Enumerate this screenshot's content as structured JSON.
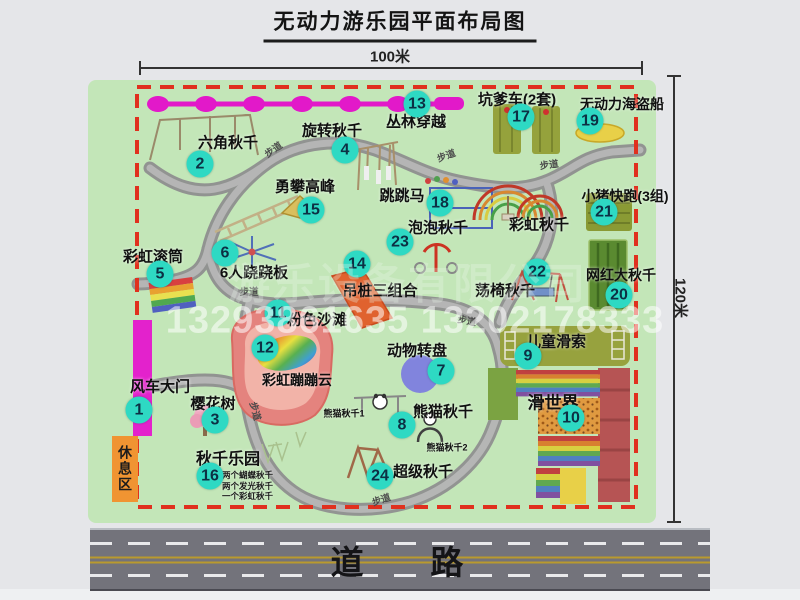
{
  "title": "无动力游乐园平面布局图",
  "dimensions": {
    "top": "100米",
    "right": "120米"
  },
  "road": {
    "label": "道    路"
  },
  "watermark": {
    "company": "游乐设备有限公司",
    "phone": "13293861635 13202178333"
  },
  "rest_area": {
    "label": "休息区"
  },
  "colors": {
    "park_green": "#c3e6b8",
    "badge": "#2ed9c3",
    "badge_text": "#0c3044",
    "border_red": "#e0301e",
    "zipline_magenta": "#e219c9",
    "gate_magenta": "#e322cc",
    "rest_orange": "#f09432",
    "road_gray": "#73737b",
    "road_yellow": "#b99a2e"
  },
  "attractions": [
    {
      "num": "1",
      "name": "风车大门",
      "label_x": 160,
      "label_y": 386,
      "badge_x": 139,
      "badge_y": 410
    },
    {
      "num": "2",
      "name": "六角秋千",
      "label_x": 228,
      "label_y": 142,
      "badge_x": 200,
      "badge_y": 164
    },
    {
      "num": "3",
      "name": "樱花树",
      "label_x": 213,
      "label_y": 403,
      "badge_x": 215,
      "badge_y": 420
    },
    {
      "num": "4",
      "name": "旋转秋千",
      "label_x": 332,
      "label_y": 130,
      "badge_x": 345,
      "badge_y": 150
    },
    {
      "num": "5",
      "name": "彩虹滚筒",
      "label_x": 153,
      "label_y": 256,
      "badge_x": 160,
      "badge_y": 274
    },
    {
      "num": "6",
      "name": "6人跷跷板",
      "label_x": 254,
      "label_y": 272,
      "badge_x": 225,
      "badge_y": 253
    },
    {
      "num": "7",
      "name": "动物转盘",
      "label_x": 417,
      "label_y": 350,
      "badge_x": 441,
      "badge_y": 371
    },
    {
      "num": "8",
      "name": "熊猫秋千",
      "label_x": 443,
      "label_y": 411,
      "badge_x": 402,
      "badge_y": 425
    },
    {
      "num": "9",
      "name": "儿童滑索",
      "label_x": 556,
      "label_y": 341,
      "badge_x": 528,
      "badge_y": 356
    },
    {
      "num": "10",
      "name": "滑世界",
      "label_x": 553,
      "label_y": 401,
      "badge_x": 571,
      "badge_y": 418,
      "label_size": 17
    },
    {
      "num": "11",
      "name": "粉色沙滩",
      "label_x": 317,
      "label_y": 319,
      "badge_x": 278,
      "badge_y": 313
    },
    {
      "num": "12",
      "name": "彩虹蹦蹦云",
      "label_x": 297,
      "label_y": 380,
      "badge_x": 265,
      "badge_y": 348,
      "label_size": 14
    },
    {
      "num": "13",
      "name": "丛林穿越",
      "label_x": 416,
      "label_y": 121,
      "badge_x": 417,
      "badge_y": 104
    },
    {
      "num": "14",
      "name": "吊桩三组合",
      "label_x": 380,
      "label_y": 290,
      "badge_x": 357,
      "badge_y": 264
    },
    {
      "num": "15",
      "name": "勇攀高峰",
      "label_x": 305,
      "label_y": 186,
      "badge_x": 311,
      "badge_y": 210
    },
    {
      "num": "16",
      "name": "秋千乐园",
      "label_x": 228,
      "label_y": 457,
      "badge_x": 210,
      "badge_y": 476,
      "label_size": 16,
      "notes": [
        "两个蝴蝶秋千",
        "两个发光秋千",
        "一个彩虹秋千"
      ],
      "notes_x": 222,
      "notes_y": 470
    },
    {
      "num": "17",
      "name": "坑爹车(2套)",
      "label_x": 517,
      "label_y": 99,
      "badge_x": 521,
      "badge_y": 117
    },
    {
      "num": "18",
      "name": "跳跳马",
      "label_x": 402,
      "label_y": 195,
      "badge_x": 440,
      "badge_y": 203
    },
    {
      "num": "19",
      "name": "无动力海盗船",
      "label_x": 622,
      "label_y": 104,
      "badge_x": 590,
      "badge_y": 121,
      "label_size": 14
    },
    {
      "num": "20",
      "name": "网红大秋千",
      "label_x": 621,
      "label_y": 275,
      "badge_x": 619,
      "badge_y": 295,
      "label_size": 14
    },
    {
      "num": "21",
      "name": "小猪快跑(3组)",
      "label_x": 625,
      "label_y": 196,
      "badge_x": 604,
      "badge_y": 212,
      "label_size": 14
    },
    {
      "num": "22",
      "name": "荡椅秋千",
      "label_x": 505,
      "label_y": 290,
      "badge_x": 537,
      "badge_y": 272
    },
    {
      "num": "23",
      "name": "泡泡秋千",
      "label_x": 438,
      "label_y": 227,
      "badge_x": 400,
      "badge_y": 242
    },
    {
      "num": "24",
      "name": "超级秋千",
      "label_x": 423,
      "label_y": 471,
      "badge_x": 380,
      "badge_y": 476
    }
  ],
  "extra_labels": [
    {
      "text": "彩虹秋千",
      "x": 539,
      "y": 224,
      "size": 15
    },
    {
      "text": "熊猫秋千1",
      "x": 344,
      "y": 413,
      "size": 9
    },
    {
      "text": "熊猫秋千2",
      "x": 447,
      "y": 447,
      "size": 9
    }
  ],
  "path_labels": [
    {
      "text": "步道",
      "x": 273,
      "y": 149,
      "rot": -35
    },
    {
      "text": "步道",
      "x": 446,
      "y": 155,
      "rot": -20
    },
    {
      "text": "步道",
      "x": 549,
      "y": 164,
      "rot": -8
    },
    {
      "text": "步道",
      "x": 249,
      "y": 291,
      "rot": 0
    },
    {
      "text": "步道",
      "x": 467,
      "y": 320,
      "rot": 10
    },
    {
      "text": "步道",
      "x": 256,
      "y": 411,
      "rot": 75
    },
    {
      "text": "步道",
      "x": 381,
      "y": 499,
      "rot": -18
    }
  ]
}
